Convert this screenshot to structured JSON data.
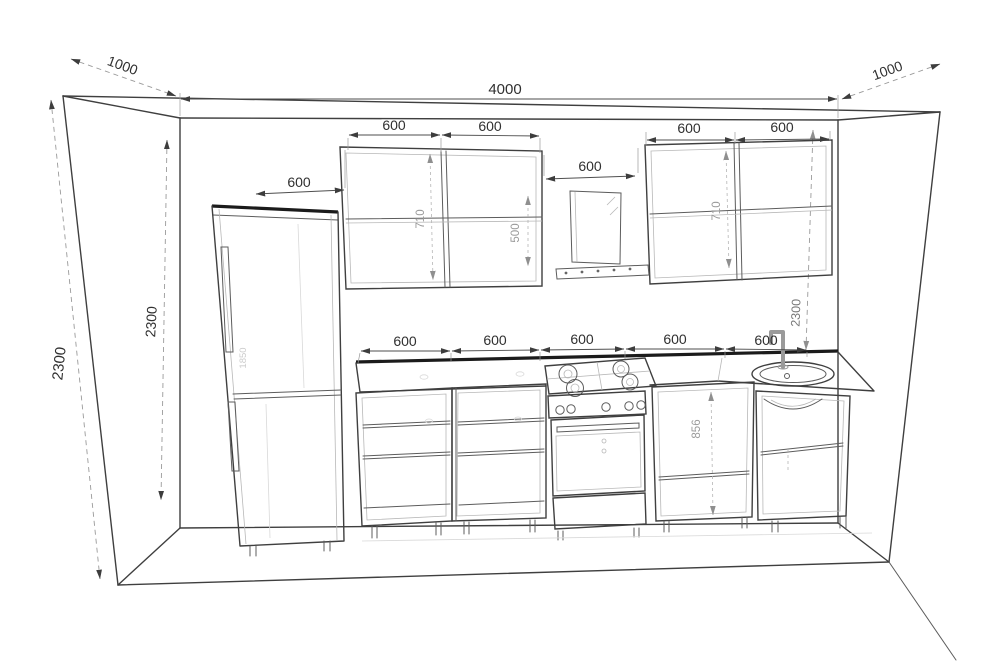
{
  "drawing": {
    "room": {
      "width": "4000",
      "depth_left": "1000",
      "depth_right": "1000",
      "height_outer": "2300",
      "height_inner": "2300",
      "height_right": "2300"
    },
    "fridge": {
      "width": "600",
      "height": "1850"
    },
    "wall_cabinets": {
      "left": [
        "600",
        "600"
      ],
      "right": [
        "600",
        "600"
      ],
      "height_left": "710",
      "height_right": "710"
    },
    "hood": {
      "width": "600",
      "clearance": "500"
    },
    "base_cabinets": {
      "widths": [
        "600",
        "600",
        "600",
        "600",
        "600"
      ],
      "height": "856"
    }
  }
}
